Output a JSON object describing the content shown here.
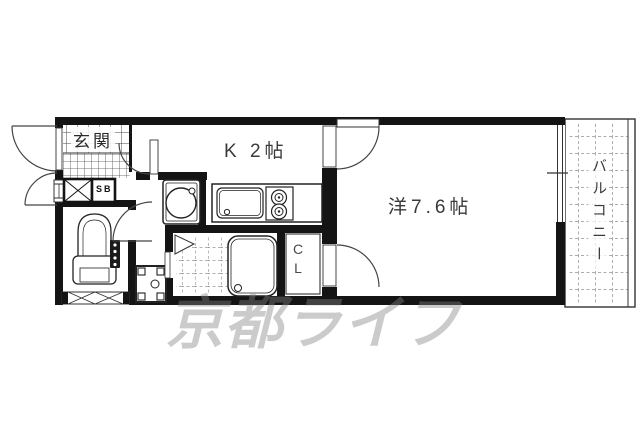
{
  "floorplan": {
    "rooms": {
      "entrance_label": "玄関",
      "kitchen_label": "K 2帖",
      "main_room_label": "洋7.6帖",
      "balcony_label": "バルコニー",
      "closet_letter_top": "C",
      "closet_letter_bottom": "L",
      "shoebox_label": "SB"
    },
    "watermark_text": "京都ライフ",
    "colors": {
      "wall": "#141414",
      "line": "#3a3a3a",
      "tile_grid": "#555555",
      "watermark": "#828282"
    },
    "fixtures": [
      "entrance-door",
      "toilet",
      "toilet-window",
      "washbasin",
      "washing-machine-pan",
      "kitchen-sink",
      "gas-stove-2-burner",
      "bathtub",
      "bathroom-folding-door",
      "closet-door",
      "room-door",
      "balcony-window",
      "shoe-box"
    ]
  }
}
